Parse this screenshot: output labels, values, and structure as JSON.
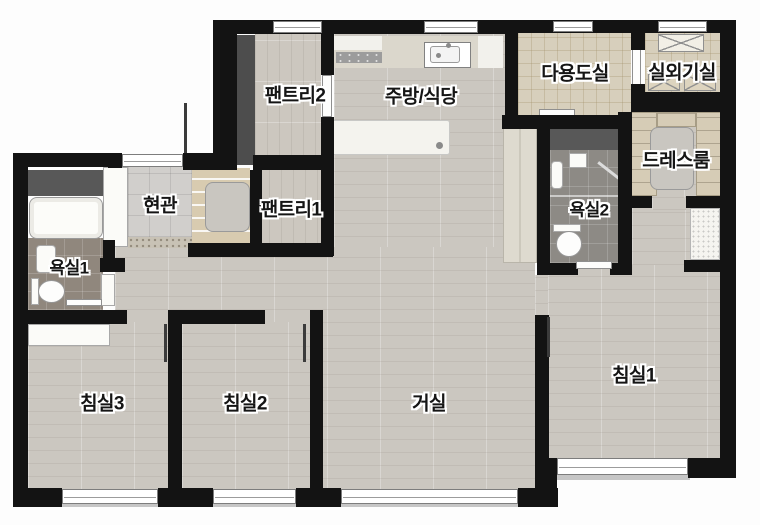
{
  "plan": {
    "type": "apartment-floor-plan",
    "rooms": [
      {
        "id": "pantry2",
        "label": "팬트리2"
      },
      {
        "id": "kitchen_dining",
        "label": "주방/식당"
      },
      {
        "id": "utility",
        "label": "다용도실"
      },
      {
        "id": "outdoor_unit",
        "label": "실외기실"
      },
      {
        "id": "dressroom",
        "label": "드레스룸"
      },
      {
        "id": "entrance",
        "label": "현관"
      },
      {
        "id": "pantry1",
        "label": "팬트리1"
      },
      {
        "id": "bathroom1",
        "label": "욕실1"
      },
      {
        "id": "bathroom2",
        "label": "욕실2"
      },
      {
        "id": "bedroom3",
        "label": "침실3"
      },
      {
        "id": "bedroom2",
        "label": "침실2"
      },
      {
        "id": "living",
        "label": "거실"
      },
      {
        "id": "bedroom1",
        "label": "침실1"
      }
    ],
    "colors": {
      "wall": "#131313",
      "wood_floor": "#cbc7c0",
      "tile_beige": "#d7cfbc",
      "tile_entrance": "#d1cfcc",
      "tile_bathroom": "#8d8a85",
      "fixture_white": "#fbfbf8",
      "shaft_gray": "#585858",
      "wardrobe_beige": "#d6ccb6",
      "window_frame": "#7d7d7d",
      "background": "#ffffff"
    },
    "fixtures": [
      "bathtub",
      "toilet",
      "washbasin",
      "kitchen-sink",
      "cooktop",
      "kitchen-island",
      "wardrobe",
      "dresser",
      "sliding-door",
      "door-leaf",
      "window",
      "front-door",
      "outdoor-unit-louver",
      "shoe-cabinet",
      "closet"
    ]
  }
}
